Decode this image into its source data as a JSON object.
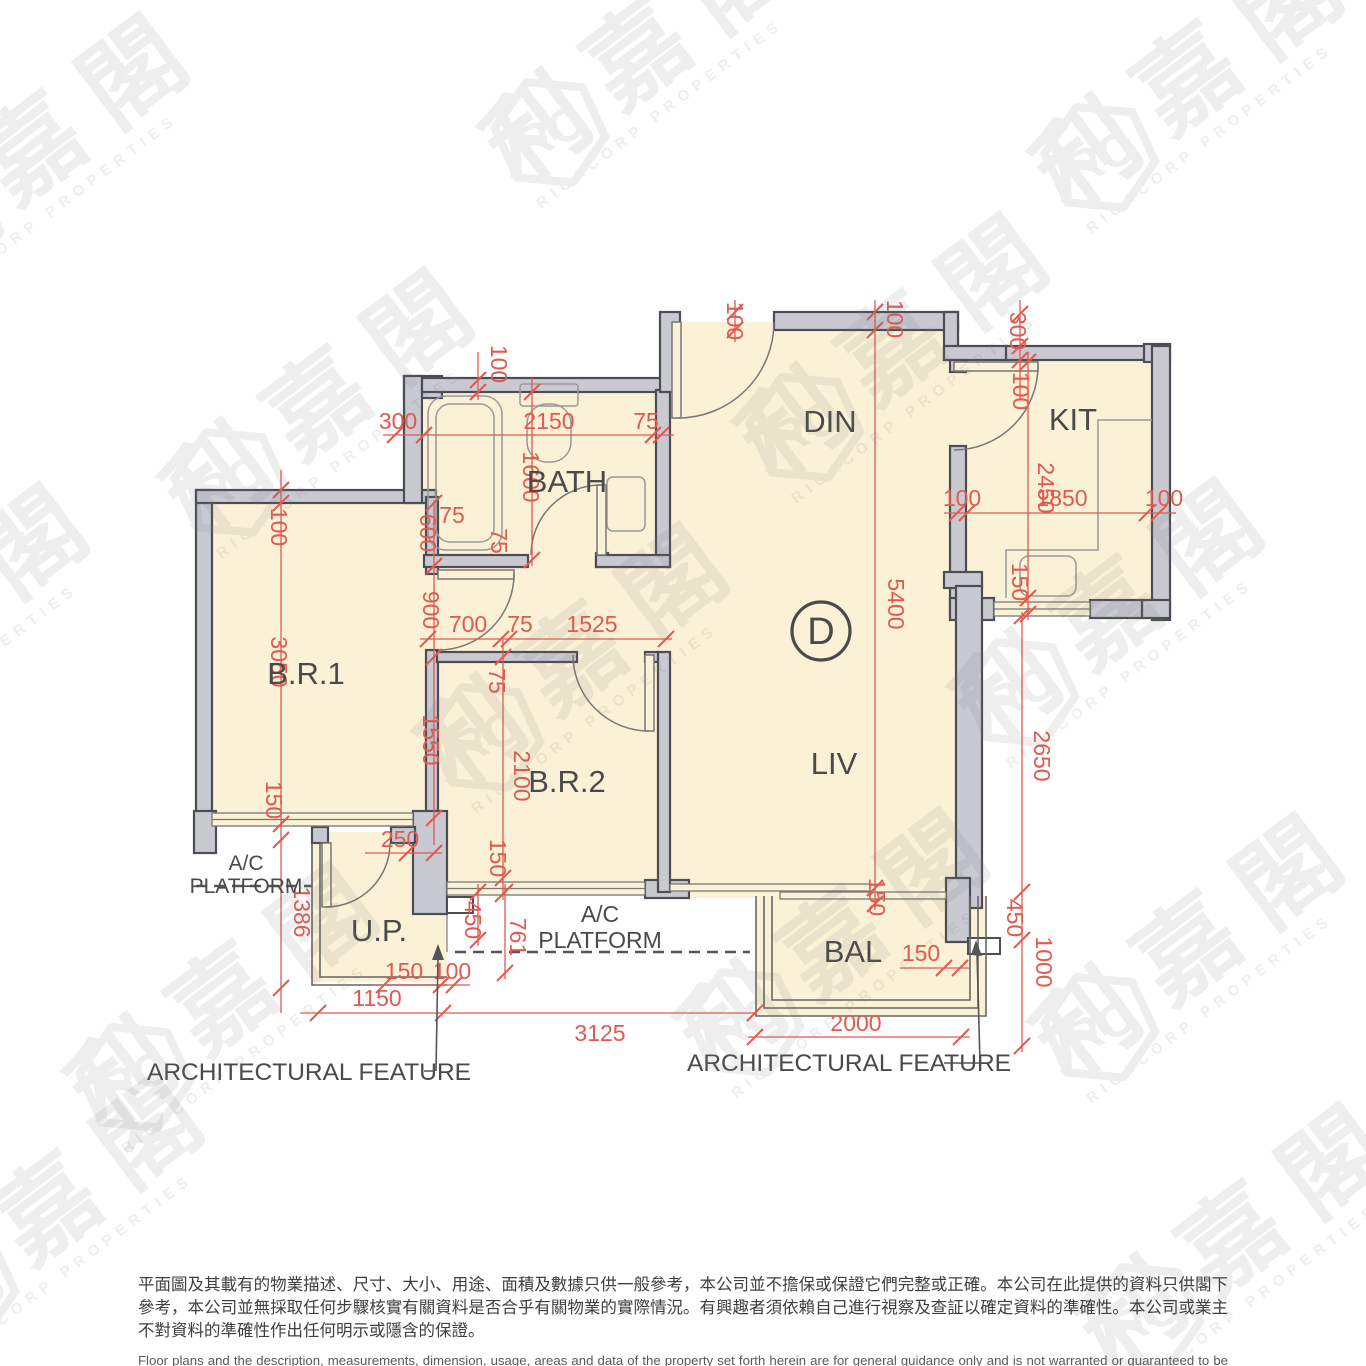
{
  "unit": {
    "label": "D"
  },
  "rooms": {
    "br1": "B.R.1",
    "br2": "B.R.2",
    "bath": "BATH",
    "din": "DIN",
    "kit": "KIT",
    "liv": "LIV",
    "bal": "BAL",
    "up": "U.P.",
    "ac_line1": "A/C",
    "ac_line2": "PLATFORM"
  },
  "annotations": {
    "architectural_feature": "ARCHITECTURAL FEATURE"
  },
  "dims": {
    "v75": "75",
    "v100": "100",
    "v150": "150",
    "v250": "250",
    "v300": "300",
    "v450": "450",
    "v600": "600",
    "v700": "700",
    "v761": "761",
    "v900": "900",
    "v1000": "1000",
    "v1150": "1150",
    "v1386": "1386",
    "v1525": "1525",
    "v1550": "1550",
    "v1600": "1600",
    "v1850": "1850",
    "v2000": "2000",
    "v2100": "2100",
    "v2150": "2150",
    "v2450": "2450",
    "v2650": "2650",
    "v3050": "3050",
    "v3125": "3125",
    "v5400": "5400"
  },
  "watermark": {
    "cn": "利嘉閣",
    "en": "RICACORP PROPERTIES",
    "logo_text": "RC"
  },
  "disclaimer": {
    "zh": "平面圖及其載有的物業描述、尺寸、大小、用途、面積及數據只供一般參考，本公司並不擔保或保證它們完整或正確。本公司在此提供的資料只供閣下參考，本公司並無採取任何步驟核實有關資料是否合乎有關物業的實際情況。有興趣者須依賴自己進行視察及查証以確定資料的準確性。本公司或業主不對資料的準確性作出任何明示或隱含的保證。",
    "en": "Floor plans and the description, measurements, dimension, usage, areas and data of the property set forth herein are for general guidance only and is not warranted or guaranteed to be complete or correct.  Interested parties should rely on their own inspection and verification and should satisfy themselves as to the accuracy of the particulars contained herein which are provided by us for information only.  Our Company has not taken any step to verify whether the information reflects the actual status of the property.  No warranty for accuracy is given or implied by the owners or us."
  },
  "colors": {
    "room_fill": "#FBF1D6",
    "wall_fill": "#C8C9D1",
    "wall_stroke": "#4D4D55",
    "dimension_red": "#E05A52",
    "label_gray": "#4A4A4A"
  }
}
